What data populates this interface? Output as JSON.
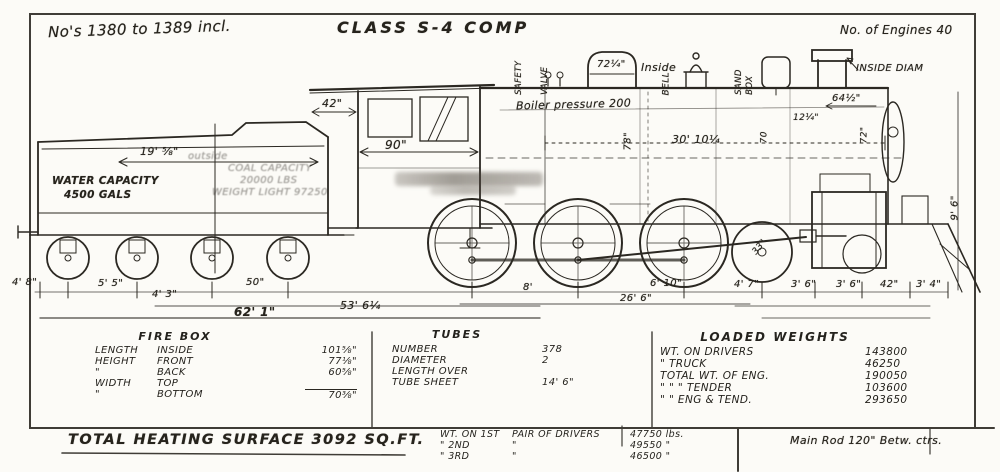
{
  "page": {
    "note_numbers": "No's 1380 to 1389 incl.",
    "title": "CLASS S-4 COMP",
    "note_engines": "No. of Engines 40"
  },
  "tender": {
    "dim_length": "19' ⅝\"",
    "dim_length_suffix": "outside",
    "water_1": "WATER CAPACITY",
    "water_2": "4500 GALS",
    "coal_1": "COAL CAPACITY",
    "coal_2": "20000 LBS",
    "coal_3": "WEIGHT LIGHT 97250"
  },
  "loco": {
    "cab_overhang": "42\"",
    "cab_width": "90\"",
    "safety_1": "SAFETY",
    "safety_2": "VALVE",
    "dome_diam": "72¼\"",
    "dome_inside": "Inside",
    "bell": "BELL",
    "sand_1": "SAND",
    "sand_2": "BOX",
    "boiler_pressure": "Boiler pressure 200",
    "boiler_diam": "78\"",
    "boiler_length": "30' 10¼",
    "dim_70": "70",
    "dim_12": "12¼\"",
    "dim_64": "64½\"",
    "dim_72": "72\"",
    "inside_diam": "INSIDE DIAM",
    "height_right": "9' 6\"",
    "wheel_33": "33\""
  },
  "dims": {
    "row1": [
      "4' 8\"",
      "5' 5\"",
      "4' 3\"",
      "50\"",
      "8'",
      "6' 10\"",
      "4' 7\"",
      "3' 6\"",
      "3' 6\"",
      "42\"",
      "3' 4\""
    ],
    "row2": [
      "26' 6\"",
      "53' 6¼",
      "62' 1\""
    ]
  },
  "firebox": {
    "title": "FIRE BOX",
    "rows": [
      {
        "c1": "LENGTH",
        "c2": "INSIDE",
        "v": "101⅝\""
      },
      {
        "c1": "HEIGHT",
        "c2": "FRONT",
        "v": "77⅛\""
      },
      {
        "c1": "\"",
        "c2": "BACK",
        "v": "60⅝\""
      },
      {
        "c1": "WIDTH",
        "c2": "TOP",
        "v": ""
      },
      {
        "c1": "\"",
        "c2": "BOTTOM",
        "v": "70⅜\""
      }
    ]
  },
  "tubes": {
    "title": "TUBES",
    "rows": [
      {
        "c1": "NUMBER",
        "v": "378"
      },
      {
        "c1": "DIAMETER",
        "v": "2"
      },
      {
        "c1": "LENGTH OVER",
        "v": ""
      },
      {
        "c1": "TUBE SHEET",
        "v": "14' 6\""
      }
    ]
  },
  "weights": {
    "title": "LOADED WEIGHTS",
    "rows": [
      {
        "c1": "WT. ON  DRIVERS",
        "v": "143800"
      },
      {
        "c1": "\"        TRUCK",
        "v": "46250"
      },
      {
        "c1": "TOTAL WT. OF ENG.",
        "v": "190050"
      },
      {
        "c1": "\"     \"     \"  TENDER",
        "v": "103600"
      },
      {
        "c1": "\"     \"   ENG & TEND.",
        "v": "293650"
      }
    ]
  },
  "footer": {
    "heating": "TOTAL HEATING SURFACE 3092 SQ.FT.",
    "drivers_rows": [
      {
        "c1": "WT. ON 1ST",
        "c2": "PAIR OF DRIVERS",
        "c3": "47750 lbs."
      },
      {
        "c1": "\"      2ND",
        "c2": "\"",
        "c3": "49550   \""
      },
      {
        "c1": "\"      3RD",
        "c2": "\"",
        "c3": "46500   \""
      }
    ],
    "main_rod": "Main Rod 120\" Betw. ctrs."
  }
}
